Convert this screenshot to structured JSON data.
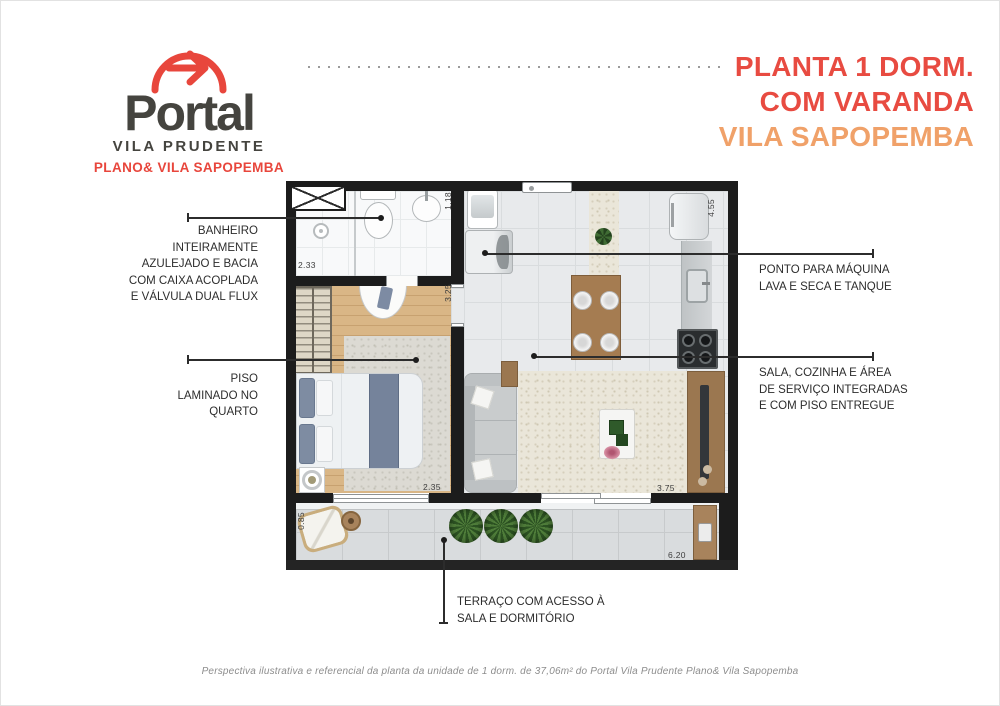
{
  "colors": {
    "brand_red": "#e8463c",
    "brand_orange": "#f0a169",
    "brand_gray": "#45443f",
    "wall_black": "#1c1c1c"
  },
  "logo": {
    "icon": "arrow-arc-icon",
    "brand": "Portal",
    "subtitle": "VILA PRUDENTE",
    "tagline": "PLANO& VILA SAPOPEMBA"
  },
  "title": {
    "line1": "PLANTA 1 DORM.",
    "line2": "COM VARANDA",
    "line3": "VILA SAPOPEMBA"
  },
  "annotations": {
    "bathroom": {
      "lines": [
        "BANHEIRO",
        "INTEIRAMENTE",
        "AZULEJADO E BACIA",
        "COM CAIXA ACOPLADA",
        "E VÁLVULA DUAL FLUX"
      ]
    },
    "laminate": {
      "lines": [
        "PISO",
        "LAMINADO NO",
        "QUARTO"
      ]
    },
    "washer": {
      "lines": [
        "PONTO PARA MÁQUINA",
        "LAVA E SECA E TANQUE"
      ]
    },
    "living": {
      "lines": [
        "SALA, COZINHA E ÁREA",
        "DE SERVIÇO INTEGRADAS",
        "E COM PISO ENTREGUE"
      ]
    },
    "terrace": {
      "lines": [
        "TERRAÇO COM ACESSO À",
        "SALA E DORMITÓRIO"
      ]
    }
  },
  "dimensions": {
    "bathroom_width": "2.33",
    "service_width": "1.18",
    "bedroom_depth": "3.25",
    "bedroom_width": "2.35",
    "kitchen_depth": "4.55",
    "living_width": "3.75",
    "terrace_width": "6.20",
    "terrace_depth": "0.85"
  },
  "footer": {
    "disclaimer": "Perspectiva ilustrativa e referencial da planta da unidade de 1 dorm. de 37,06m² do Portal Vila Prudente Plano& Vila Sapopemba"
  }
}
